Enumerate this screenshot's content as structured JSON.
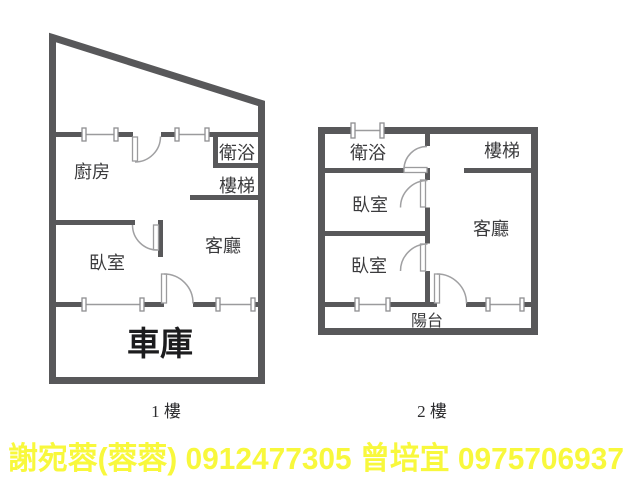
{
  "colors": {
    "wall": "#58585a",
    "light": "#9b9b9d",
    "text": "#3b3b3d",
    "garage_text": "#1c1c1e",
    "contact_yellow": "#f8f83c",
    "background": "#ffffff"
  },
  "floor1": {
    "label": "1 樓",
    "rooms": {
      "kitchen": "廚房",
      "bath": "衛浴",
      "stairs": "樓梯",
      "bedroom": "臥室",
      "living": "客廳",
      "garage": "車庫"
    }
  },
  "floor2": {
    "label": "2 樓",
    "rooms": {
      "bath": "衛浴",
      "stairs": "樓梯",
      "bedroom1": "臥室",
      "living": "客廳",
      "bedroom2": "臥室",
      "balcony": "陽台"
    }
  },
  "footer": {
    "agents": [
      {
        "name": "謝宛蓉(蓉蓉)",
        "phone": "0912477305"
      },
      {
        "name": "曾培宜",
        "phone": "0975706937"
      }
    ],
    "text": "謝宛蓉(蓉蓉)  0912477305  曾培宜 0975706937"
  }
}
